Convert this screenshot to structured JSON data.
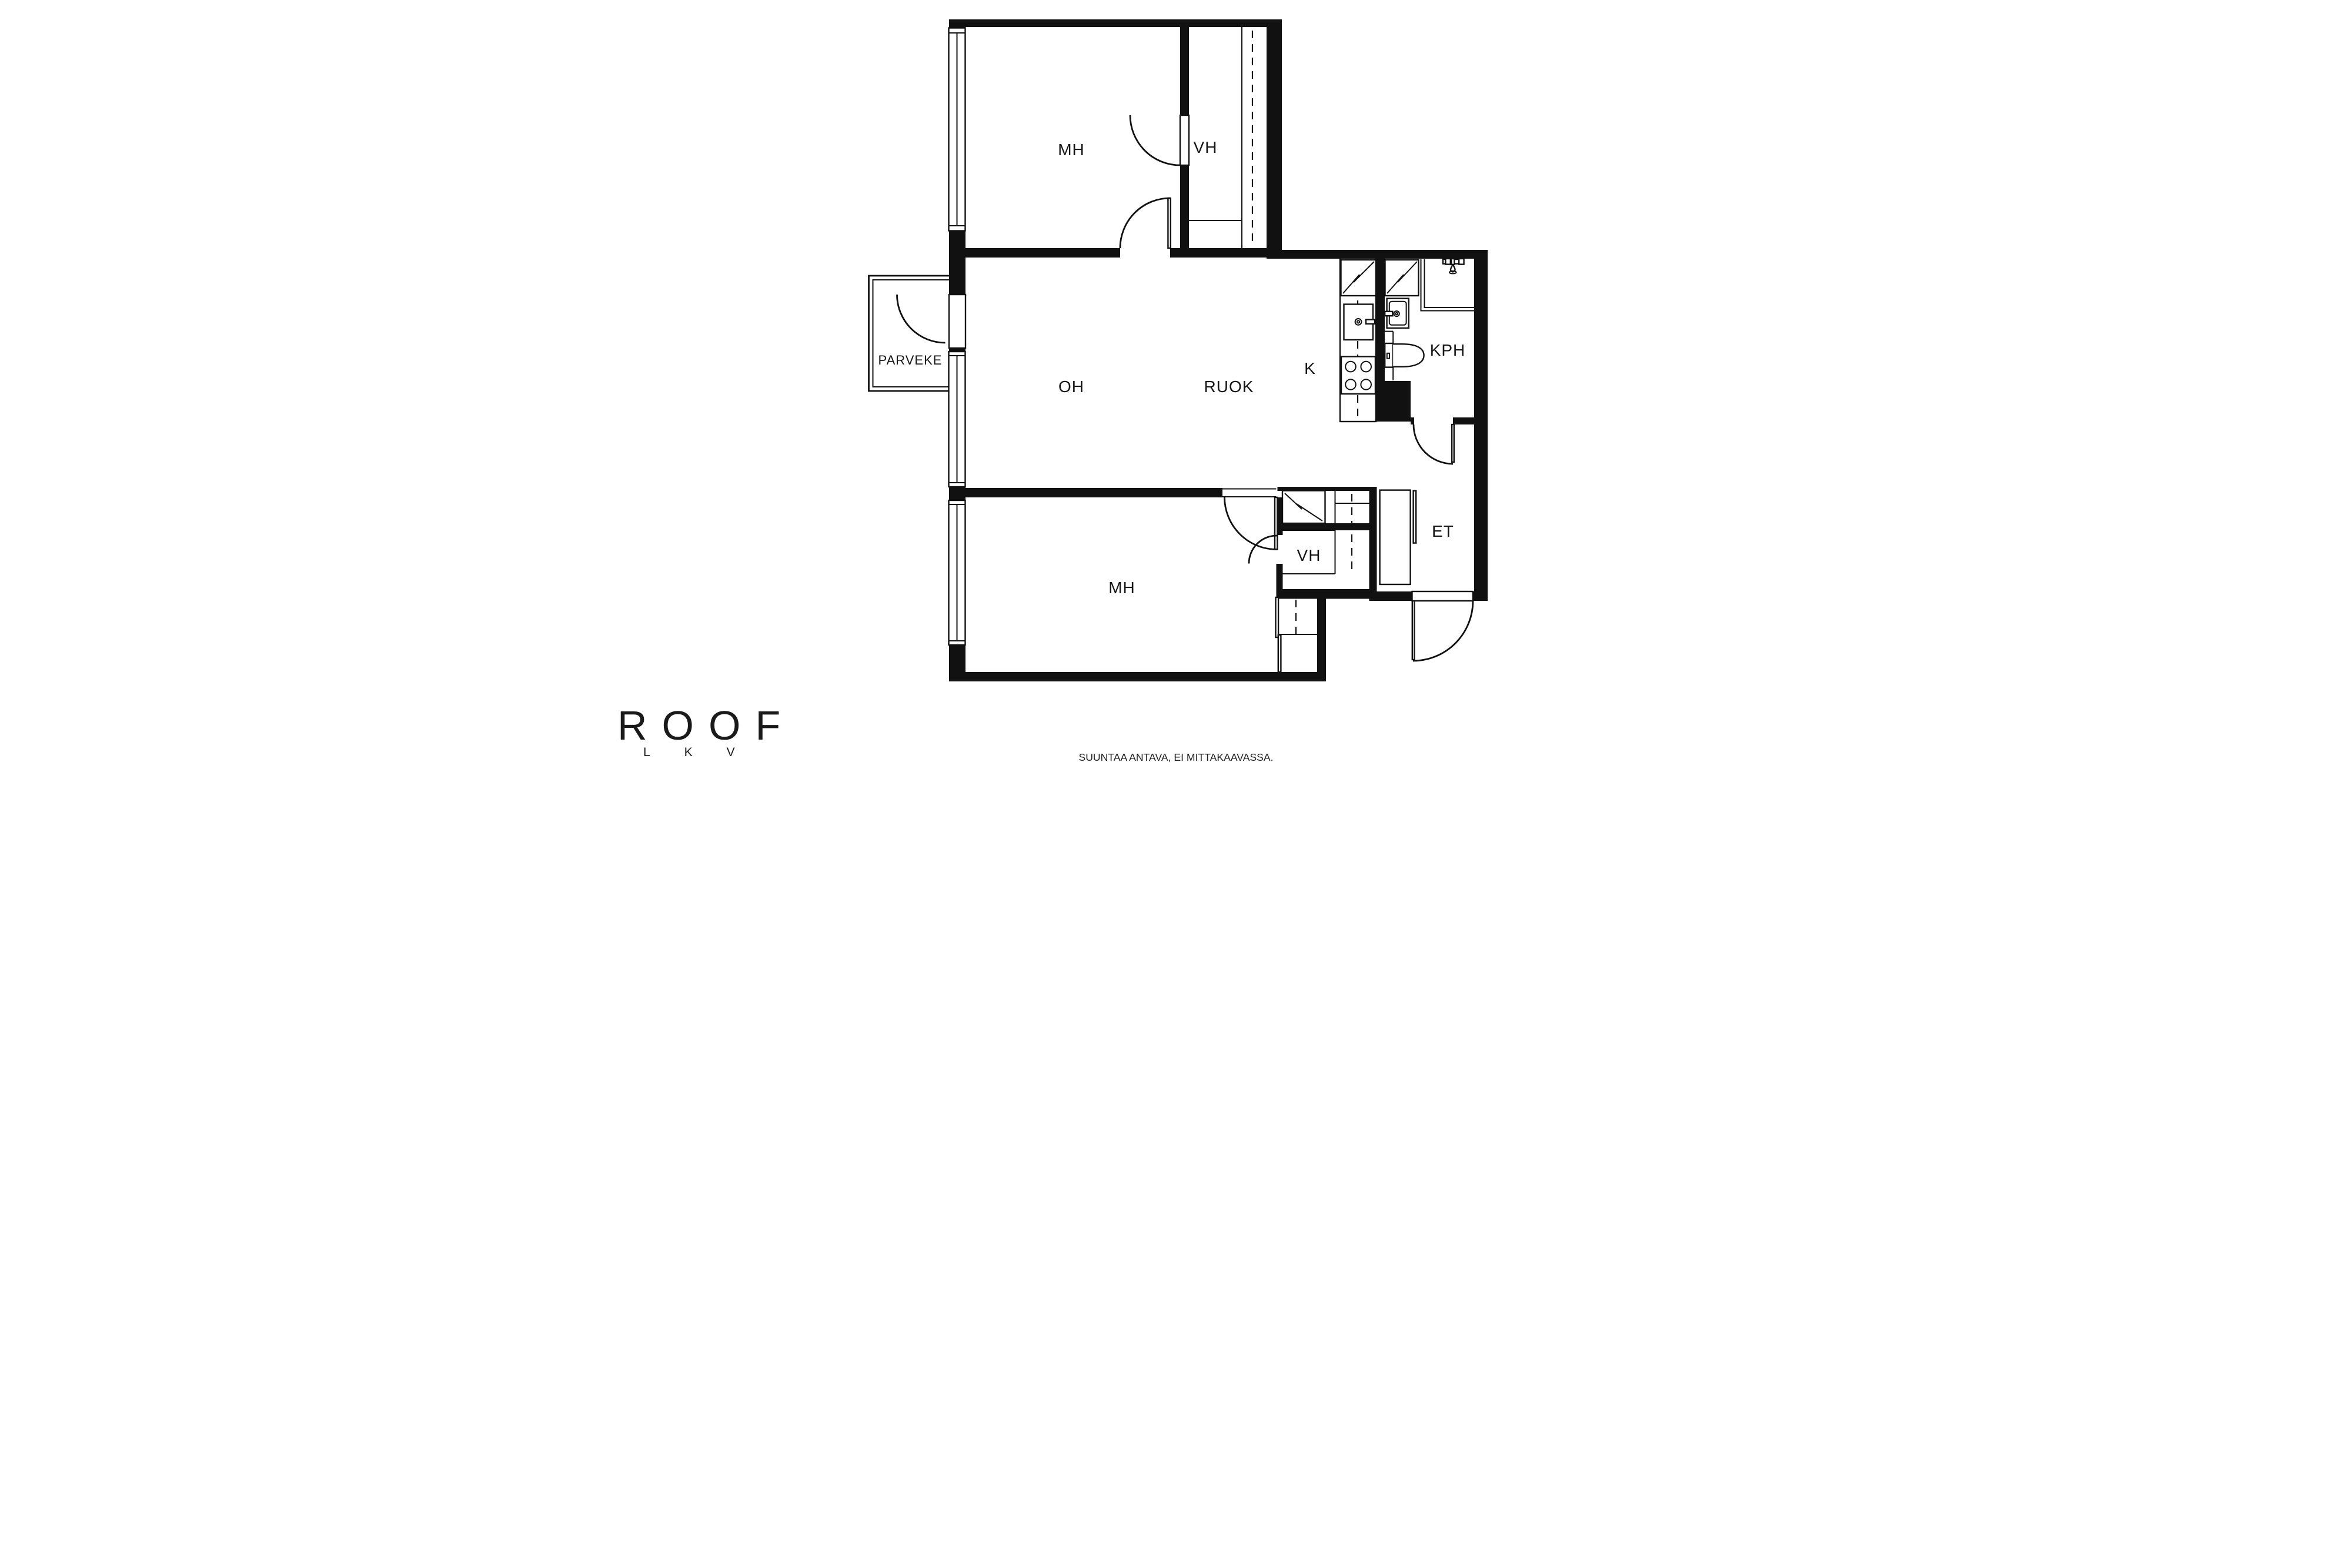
{
  "page": {
    "background": "#ffffff",
    "ink": "#111111"
  },
  "plan": {
    "labels": {
      "mh_top": "MH",
      "vh_top": "VH",
      "parveke": "PARVEKE",
      "oh": "OH",
      "ruok": "RUOK",
      "k": "K",
      "kph": "KPH",
      "et": "ET",
      "mh_bottom": "MH",
      "vh_bottom": "VH"
    }
  },
  "branding": {
    "logo": "ROOF",
    "logo_sub": "LKV"
  },
  "footer": {
    "disclaimer": "SUUNTAA ANTAVA, EI MITTAKAAVASSA."
  }
}
